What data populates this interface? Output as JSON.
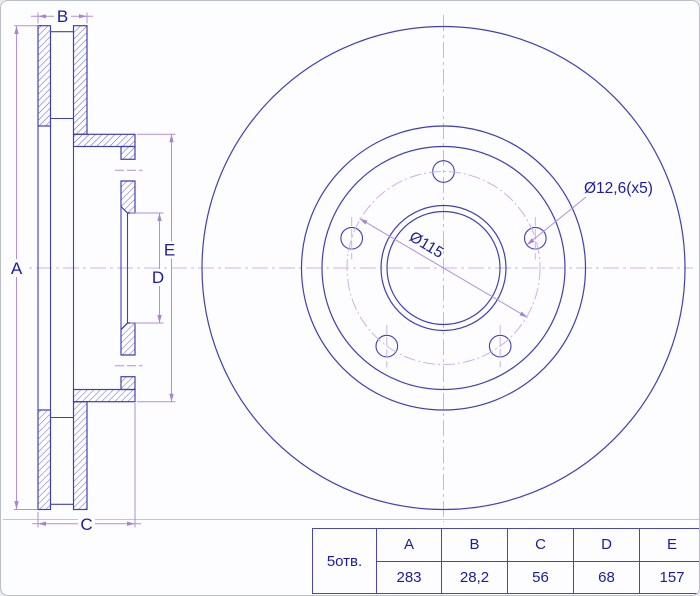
{
  "drawing": {
    "dim_labels": {
      "A": "A",
      "B": "B",
      "C": "C",
      "D": "D",
      "E": "E"
    },
    "annotations": {
      "bolt_circle_diameter": "Ø115",
      "bolt_hole_diameter": "Ø12,6(x5)"
    }
  },
  "table": {
    "row_label": "5отв.",
    "headers": [
      "A",
      "B",
      "C",
      "D",
      "E"
    ],
    "values": [
      "283",
      "28,2",
      "56",
      "68",
      "157"
    ]
  },
  "colors": {
    "outline_blue": "#4040b5",
    "hatch_blue": "#5454c4",
    "dimension_lavender": "#b08fdc",
    "centerline_lavender": "#c9b2ee",
    "text_navy": "#1b1ba0"
  }
}
